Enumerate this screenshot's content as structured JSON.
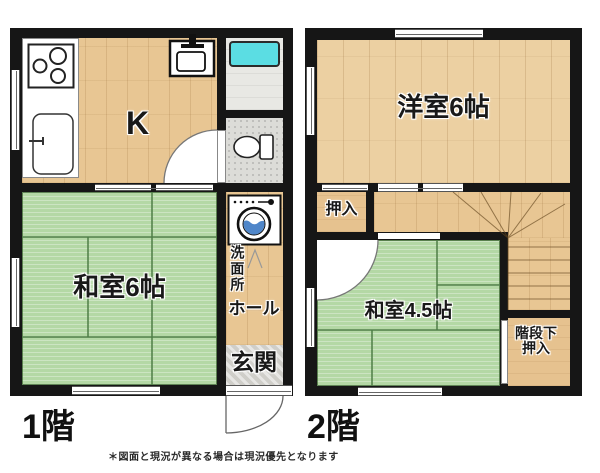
{
  "plan": {
    "floor1": {
      "label": "1階",
      "rooms": {
        "kitchen": "K",
        "washitsu": "和室6帖",
        "senmenjo": "洗面所",
        "hall": "ホール",
        "genkan": "玄関"
      }
    },
    "floor2": {
      "label": "2階",
      "rooms": {
        "yoshitsu": "洋室6帖",
        "oshiire": "押入",
        "washitsu": "和室4.5帖",
        "kaidanshita_line1": "階段下",
        "kaidanshita_line2": "押入"
      }
    },
    "caption": "＊図面と現況が異なる場合は現況優先となります",
    "icons": [
      "stove-icon",
      "sink-icon",
      "water-heater-icon",
      "bathtub-icon",
      "toilet-icon",
      "washing-machine-icon",
      "staircase",
      "door-swing"
    ],
    "colors": {
      "wall": "#161616",
      "wood_floor": "#e8c693",
      "wood_floor_light": "#ecd0a2",
      "tatami_green": "#b4d8a5",
      "tatami_line": "#4e7e46",
      "bathtub": "#5bdde3",
      "washer_water": "#4f86c9",
      "bath_floor": "#e8e8e4",
      "toilet_floor": "#dcdcd8",
      "genkan_floor": "#cfcec9"
    }
  }
}
